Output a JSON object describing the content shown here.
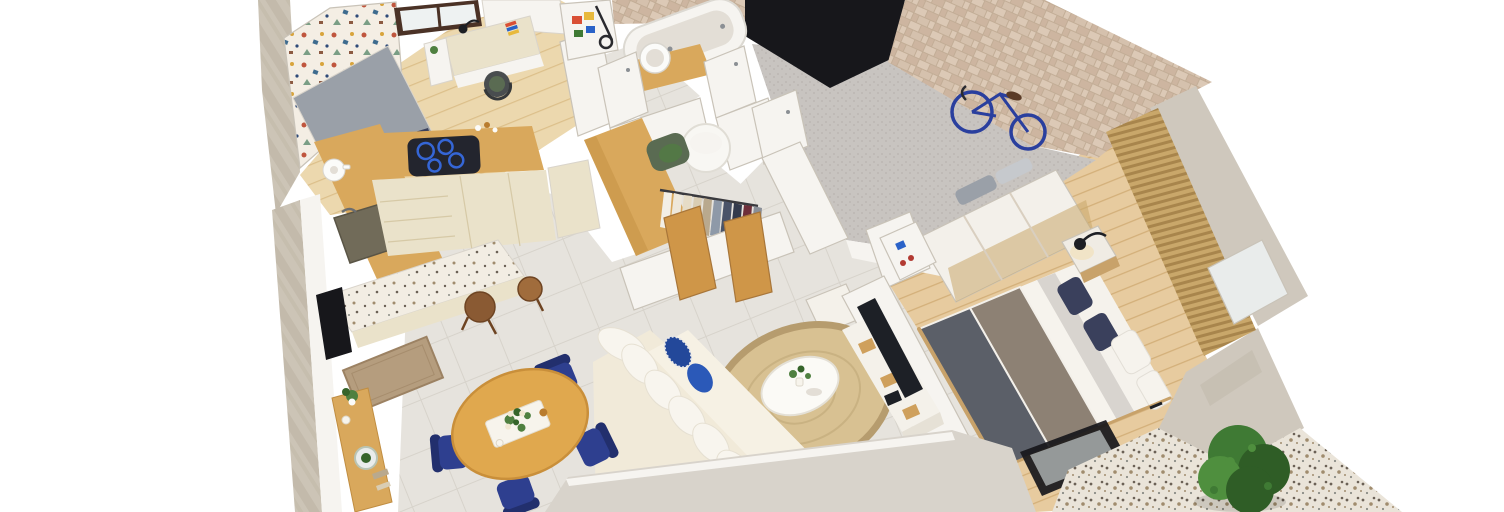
{
  "scene": {
    "description": "Photorealistic top-down 3D floor plan render of a one-bedroom apartment, slightly rotated isometric bird's-eye view on a white background",
    "background": "#ffffff"
  },
  "colors": {
    "stone": "#ccc4b6",
    "stone_dark": "#b9b0a0",
    "wall_white": "#f6f4f0",
    "wall_edge": "#e3ded6",
    "wall_band": "#d8d3cb",
    "wallpaper_base": "#f4eee4",
    "wp_red": "#c0563e",
    "wp_blue": "#3e6b8e",
    "wp_gold": "#d8a43c",
    "wp_green": "#7a9e85",
    "wp_brown": "#8c5a42",
    "wp_navy": "#2e4a78",
    "window_frame": "#4b3226",
    "window_pane": "#eef2f2",
    "wood_floor": "#ecd8ae",
    "wood_floor_line": "#dcbf8a",
    "bedroom_floor": "#e7cb9f",
    "bedroom_floor_line": "#d2ae77",
    "tile_floor": "#e6e3dd",
    "tile_line": "#d7d3cb",
    "carpet": "#c8c4c0",
    "carpet_dot": "#b9b4b0",
    "tilewall_a": "#dcc9b6",
    "tilewall_b": "#cdb5a0",
    "tilewall_c": "#d5c1ad",
    "tilewall_gap": "#c2ad96",
    "black": "#17171b",
    "concrete": "#cfc8bd",
    "concrete_dark": "#bcb4a6",
    "patio": "#eae4d9",
    "speck_dark": "#6b6156",
    "speck_mid": "#a08c6e",
    "speck_gray": "#8a8c86",
    "counter_wood": "#d9a85c",
    "counter_wood_dark": "#c08d41",
    "cabinet_cream": "#eae2ca",
    "cabinet_line": "#d6c9a6",
    "hob": "#23252e",
    "hob_ring": "#3566d6",
    "sink": "#716b59",
    "steel": "#8b8f94",
    "coffee_white": "#fbfbf9",
    "island_top": "#f2ede3",
    "stool": "#8a5a33",
    "stool_light": "#a06c3c",
    "table": "#e0a84e",
    "table_dark": "#c98f3a",
    "tray": "#f7f4ec",
    "flower_cream": "#f1e8d2",
    "leaf": "#4f8040",
    "leaf_dark": "#35642a",
    "bottle_amber": "#b97c2e",
    "chair_blue": "#2e3f8f",
    "chair_blue_dark": "#222f6d",
    "sofa": "#f1ead9",
    "sofa_seat": "#f6f1e4",
    "pillow": "#f8f5ee",
    "pillow_blue": "#2b59b8",
    "pillow_pattern": "#23489a",
    "rug": "#d8c192",
    "rug_ring": "#b69c6e",
    "coffee_table": "#fbfaf6",
    "tv": "#1d2026",
    "tv_unit": "#f4f1ea",
    "tv_unit_side": "#e6e1d6",
    "wood_shelf": "#cfa05c",
    "bed_sheet": "#f5f2ec",
    "duvet_light": "#d8d4cf",
    "duvet_taupe": "#8d8174",
    "duvet_dark": "#5b5f68",
    "pillow_navy": "#3a405c",
    "pillow_white": "#f6f3ed",
    "bedframe": "#c8a26a",
    "nightstand": "#f0ece4",
    "lamp_black": "#1d1f24",
    "lamp_glow": "#f3dfae",
    "slat_a": "#c9a76a",
    "slat_b": "#a8854c",
    "mirror": "#e9eceb",
    "wardrobe_white": "#f3f0ea",
    "trim_gold": "#c9a86a",
    "towel_gray": "#9aa0a8",
    "towel_light": "#c6c9cd",
    "shoe_blue": "#2a62c8",
    "shoe_red": "#b23a32",
    "door_wood": "#cf9648",
    "hamper": "#f8f7f3",
    "chair_green": "#5a6b52",
    "chair_dark": "#494d4f",
    "cloth1": "#f3efe6",
    "cloth2": "#eee8da",
    "cloth3": "#e6dcc6",
    "cloth4": "#d9cdb4",
    "cloth5": "#b9a98e",
    "cloth6": "#8e99a8",
    "cloth7": "#4a5368",
    "cloth8": "#343b4d",
    "cloth9": "#6e2f3a",
    "cloth10": "#8a8f98",
    "bike": "#2a3f9e",
    "saddle": "#5a3a26",
    "glass": "#a9aeae",
    "bush": "#3f7a34",
    "bush_dark": "#2f5d26",
    "bush_light": "#4f8f3e",
    "mat": "#b59d7e",
    "mat_dark": "#9c8263",
    "bin_red": "#d94f35",
    "bin_yellow": "#e8b93c",
    "bin_green": "#3f7a34",
    "bin_blue": "#2a62c8",
    "shadow": "#000000"
  },
  "rooms": [
    {
      "name": "kids-room",
      "furniture": [
        "single bed with gray bedding",
        "terrazzo wallpaper accent wall",
        "dark framed window",
        "desk",
        "desk lamp",
        "colorful books",
        "shelf unit with plant",
        "desk chair with green seat"
      ]
    },
    {
      "name": "kitchen",
      "furniture": [
        "L-shaped wooden countertop",
        "induction hob with blue rings",
        "dark stone sink",
        "white coffee machine",
        "cream base cabinets",
        "terrazzo breakfast island",
        "2 wooden bar stools"
      ]
    },
    {
      "name": "dining-area",
      "furniture": [
        "round wooden table",
        "white tray with flower centerpiece",
        "4 navy upholstered chairs",
        "wooden console with plant and terrarium",
        "doormat",
        "dark cabinet"
      ]
    },
    {
      "name": "living-room",
      "furniture": [
        "cream fabric sofa",
        "5 white back cushions",
        "blue patterned pillow",
        "royal blue pillow",
        "round jute rug",
        "white organic coffee table with plant",
        "wall-mounted TV",
        "white media cabinet with wood shelves"
      ]
    },
    {
      "name": "bathroom",
      "furniture": [
        "white bathtub",
        "round vessel sink on wooden vanity",
        "beige tiled wall",
        "white doors with handles"
      ]
    },
    {
      "name": "walk-in-closet",
      "furniture": [
        "wooden wardrobe",
        "two open wooden doors",
        "clothes rail with hanging garments",
        "white laundry hamper",
        "green armchair"
      ]
    },
    {
      "name": "entry-hall",
      "furniture": [
        "gray carpet",
        "blue bicycle leaning on tiled wall",
        "beige stone tile wall",
        "dark doorway",
        "storage shelf with colored bins",
        "white bench"
      ]
    },
    {
      "name": "bedroom",
      "furniture": [
        "double bed with layered gray and taupe bedding",
        "2 navy pillows",
        "2 white pillows",
        "nightstand with black reading lamp",
        "white sliding wardrobe with brass panels",
        "gray towel stacks",
        "open shoe shelf",
        "vertical wood slat wall",
        "mirror panel",
        "sliding glass door"
      ]
    },
    {
      "name": "patio",
      "furniture": [
        "terrazzo paving",
        "green shrub",
        "thick concrete perimeter walls"
      ]
    }
  ],
  "counts": {
    "dining_chairs": 4,
    "bar_stools": 2,
    "sofa_back_pillows": 5,
    "bed_pillows": 4,
    "bicycles": 1
  }
}
